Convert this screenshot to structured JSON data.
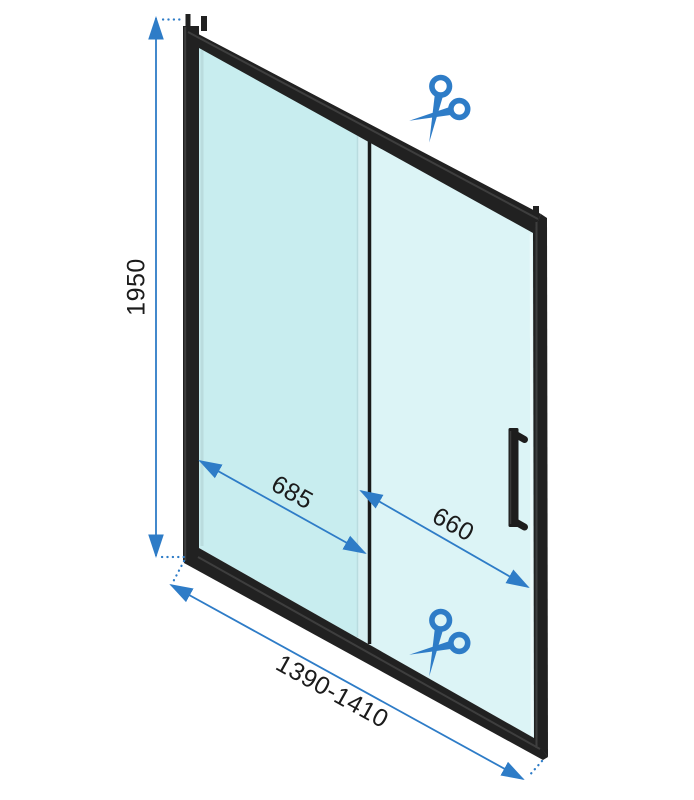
{
  "colors": {
    "accent": "#2e7cc7",
    "frame": "#212121",
    "frame_highlight": "#3e3e3e",
    "glass_left": "#c8edef",
    "glass_right": "#dcf4f6",
    "glass_divider": "#d7f0f2",
    "ink": "#1b1b1b"
  },
  "dimensions": {
    "height": "1950",
    "panel_fixed": "685",
    "panel_door": "660",
    "total_width": "1390-1410"
  },
  "icons": {
    "cut_top": "scissors-icon",
    "cut_bottom": "scissors-icon"
  }
}
